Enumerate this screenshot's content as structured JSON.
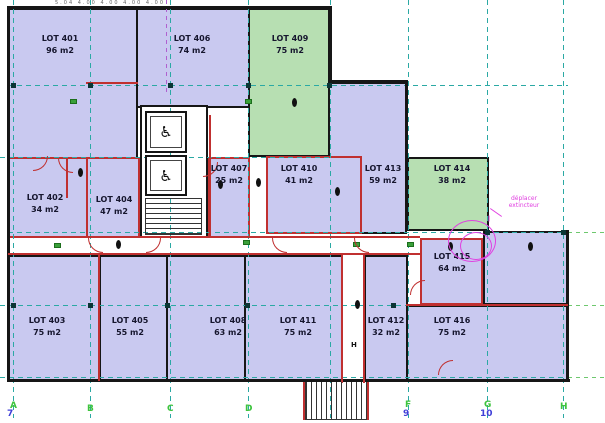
{
  "plan": {
    "dim_note": "5.04 4.00 4.00 4.00 4.00",
    "colors": {
      "room_purple": "#c9c9f0",
      "room_green": "#b7dfb2",
      "wall_black": "#161616",
      "wall_red": "#c03030",
      "grid_teal": "#2ba9a4",
      "grid_purple": "#b060d0",
      "label_green": "#3ec43e",
      "label_blue": "#4040d8",
      "annotation_magenta": "#e040e0"
    }
  },
  "rooms": {
    "401": {
      "name": "LOT 401",
      "area": "96 m2",
      "type": "purple"
    },
    "402": {
      "name": "LOT 402",
      "area": "34 m2",
      "type": "purple"
    },
    "403": {
      "name": "LOT 403",
      "area": "75 m2",
      "type": "purple"
    },
    "404": {
      "name": "LOT 404",
      "area": "47 m2",
      "type": "purple"
    },
    "405": {
      "name": "LOT 405",
      "area": "55 m2",
      "type": "purple"
    },
    "406": {
      "name": "LOT 406",
      "area": "74 m2",
      "type": "purple"
    },
    "407": {
      "name": "LOT 407",
      "area": "25 m2",
      "type": "purple"
    },
    "408": {
      "name": "LOT 408",
      "area": "63 m2",
      "type": "purple"
    },
    "409": {
      "name": "LOT 409",
      "area": "75 m2",
      "type": "green"
    },
    "410": {
      "name": "LOT 410",
      "area": "41 m2",
      "type": "purple"
    },
    "411": {
      "name": "LOT 411",
      "area": "75 m2",
      "type": "purple"
    },
    "412": {
      "name": "LOT 412",
      "area": "32 m2",
      "type": "purple"
    },
    "413": {
      "name": "LOT 413",
      "area": "59 m2",
      "type": "purple"
    },
    "414": {
      "name": "LOT 414",
      "area": "38 m2",
      "type": "green"
    },
    "415": {
      "name": "LOT 415",
      "area": "64 m2",
      "type": "purple"
    },
    "416": {
      "name": "LOT 416",
      "area": "75 m2",
      "type": "purple"
    }
  },
  "grid": {
    "letters": [
      "A",
      "B",
      "C",
      "D",
      "F",
      "G",
      "H"
    ],
    "numbers": [
      "7",
      "9",
      "10"
    ]
  },
  "annotation": {
    "line1": "déplacer",
    "line2": "extincteur"
  },
  "symbols": {
    "wheelchair": "♿",
    "hydrant": "H"
  }
}
